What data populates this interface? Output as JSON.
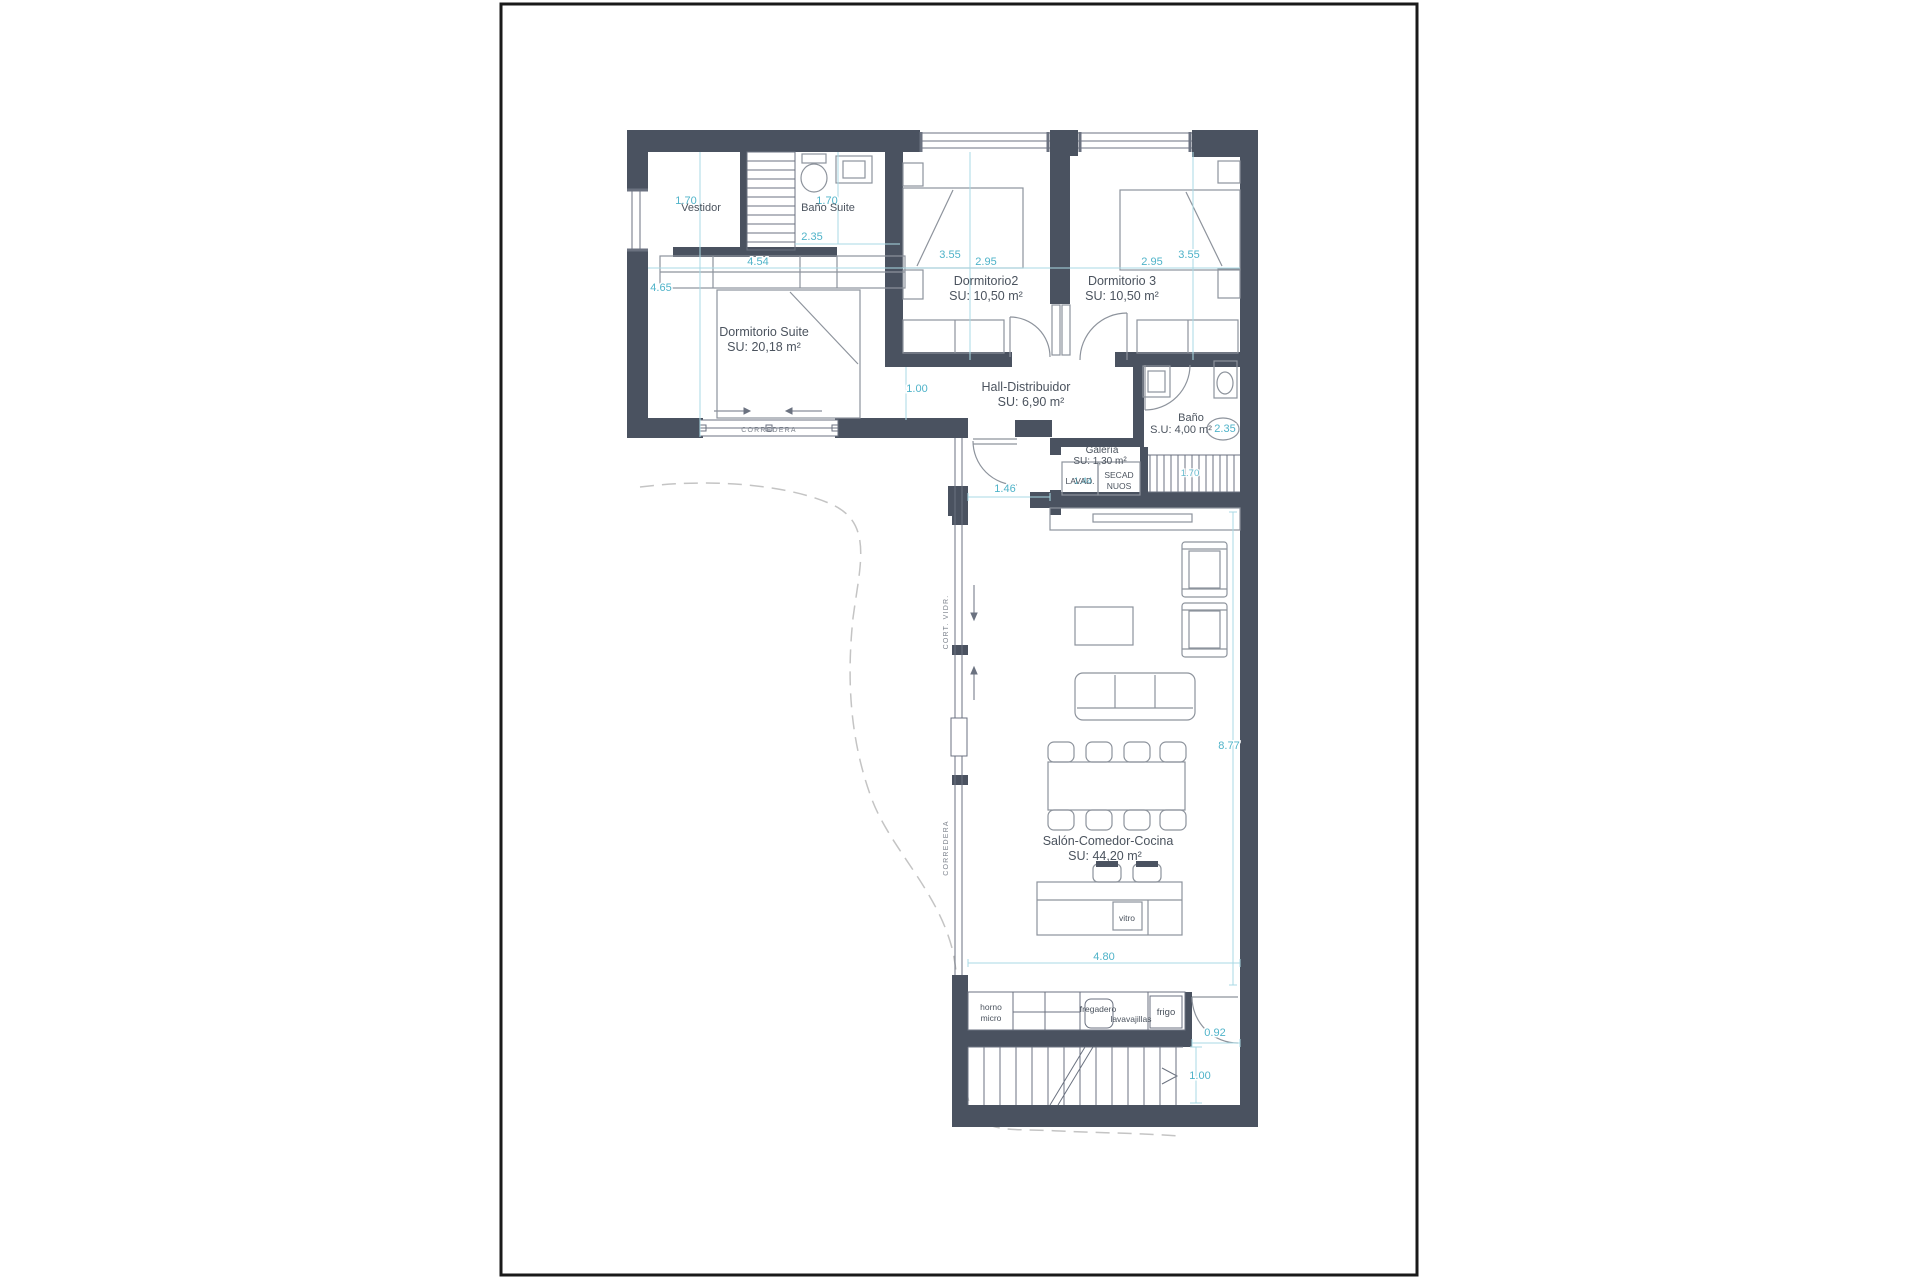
{
  "plan": {
    "rooms": {
      "vestidor": {
        "name": "Vestidor"
      },
      "bano_suite": {
        "name": "Baño Suite"
      },
      "dormitorio_suite": {
        "name": "Dormitorio Suite",
        "area": "SU: 20,18 m²"
      },
      "dormitorio2": {
        "name": "Dormitorio2",
        "area": "SU: 10,50 m²"
      },
      "dormitorio3": {
        "name": "Dormitorio 3",
        "area": "SU: 10,50 m²"
      },
      "hall": {
        "name": "Hall-Distribuidor",
        "area": "SU: 6,90 m²"
      },
      "bano": {
        "name": "Baño",
        "area": "S.U: 4,00 m²"
      },
      "galeria": {
        "name": "Galería",
        "area": "SU: 1,30 m²"
      },
      "salon": {
        "name": "Salón-Comedor-Cocina",
        "area": "SU: 44,20 m²"
      }
    },
    "appliances": {
      "lavadora": "LAVAD.",
      "secadora": "SECAD",
      "nuos": "NUOS",
      "horno_line1": "horno",
      "horno_line2": "micro",
      "fregadero": "fregadero",
      "lavavajillas": "lavavajillas",
      "frigo": "frigo",
      "vitro": "vitro"
    },
    "window_labels": {
      "corredera_suite": "CORREDERA",
      "corredera_salon_upper": "CORT. VIDR.",
      "corredera_salon_lower": "CORREDERA"
    },
    "dimensions": {
      "vestidor_width": "1.70",
      "suite_height": "4.65",
      "bano_suite_width": "2.35",
      "suite_width": "4.54",
      "bano_suite_height": "1.70",
      "dorm2_height": "3.55",
      "dorm2_width": "2.95",
      "dorm3_width": "2.95",
      "dorm3_height": "3.55",
      "hall_width": "1.00",
      "bano_width": "2.35",
      "stairs_width": "1.70",
      "galeria_width": "1.44",
      "salon_opening": "1.46",
      "salon_height": "8.77",
      "salon_width": "4.80",
      "entry_width": "0.92",
      "entry_height": "1.00"
    },
    "colors": {
      "wall": "#4a5260",
      "dimension": "#4fb3c9",
      "dimension_line": "#a9d9e4",
      "label": "#4b535e",
      "furniture": "#8d939c",
      "outline": "#6b7280",
      "boundary_dash": "#c4c4c4",
      "frame": "#1a1a1a"
    }
  }
}
